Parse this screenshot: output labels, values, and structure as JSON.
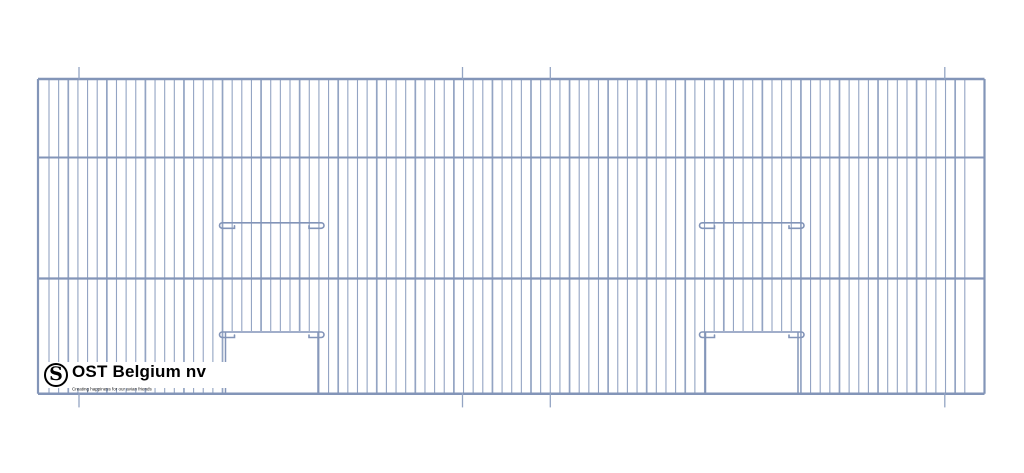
{
  "page": {
    "background": "#ffffff",
    "description": "Technical drawing of a wire cage front panel with two door openings"
  },
  "logo": {
    "monogram": "S",
    "company": "OST Belgium nv",
    "tagline": "Creating happiness for our avian friends",
    "text_color": "#000000"
  },
  "drawing": {
    "canvas": {
      "width": 1024,
      "height": 473
    },
    "colors": {
      "wire": "#93a4c3",
      "frame": "#8395b8",
      "bar": "#8294b8",
      "tick": "#93a4c3",
      "background": "#ffffff"
    },
    "frame": {
      "x0": 38,
      "x1": 984.5,
      "top": 79,
      "bottom": 393.8,
      "edge_width": 2.2
    },
    "rails": [
      {
        "y": 79,
        "w": 2.5
      },
      {
        "y": 157.5,
        "w": 2.0
      },
      {
        "y": 278.5,
        "w": 2.2
      },
      {
        "y": 393.8,
        "w": 2.5
      }
    ],
    "wires": {
      "x_start": 49,
      "spacing": 9.64,
      "count": 96,
      "width": 1.1,
      "accent_width": 1.7,
      "accent_every": 4
    },
    "ticks": {
      "xs": [
        79,
        462.5,
        550.3,
        944.8
      ],
      "top_from": 67,
      "top_to": 79.5,
      "bottom_from": 393,
      "bottom_to": 407.4,
      "width": 1.3
    },
    "doors": [
      {
        "x0": 225.5,
        "x1": 318
      },
      {
        "x0": 705.5,
        "x1": 798
      }
    ],
    "bars": {
      "perch_y": 222.8,
      "door_bar_y": 332,
      "hook_drop": 5.5,
      "hook_margin": 6,
      "stub_in": 15,
      "stub_tick": 2.5,
      "width": 1.6
    },
    "door_edge_width": 1.5
  }
}
